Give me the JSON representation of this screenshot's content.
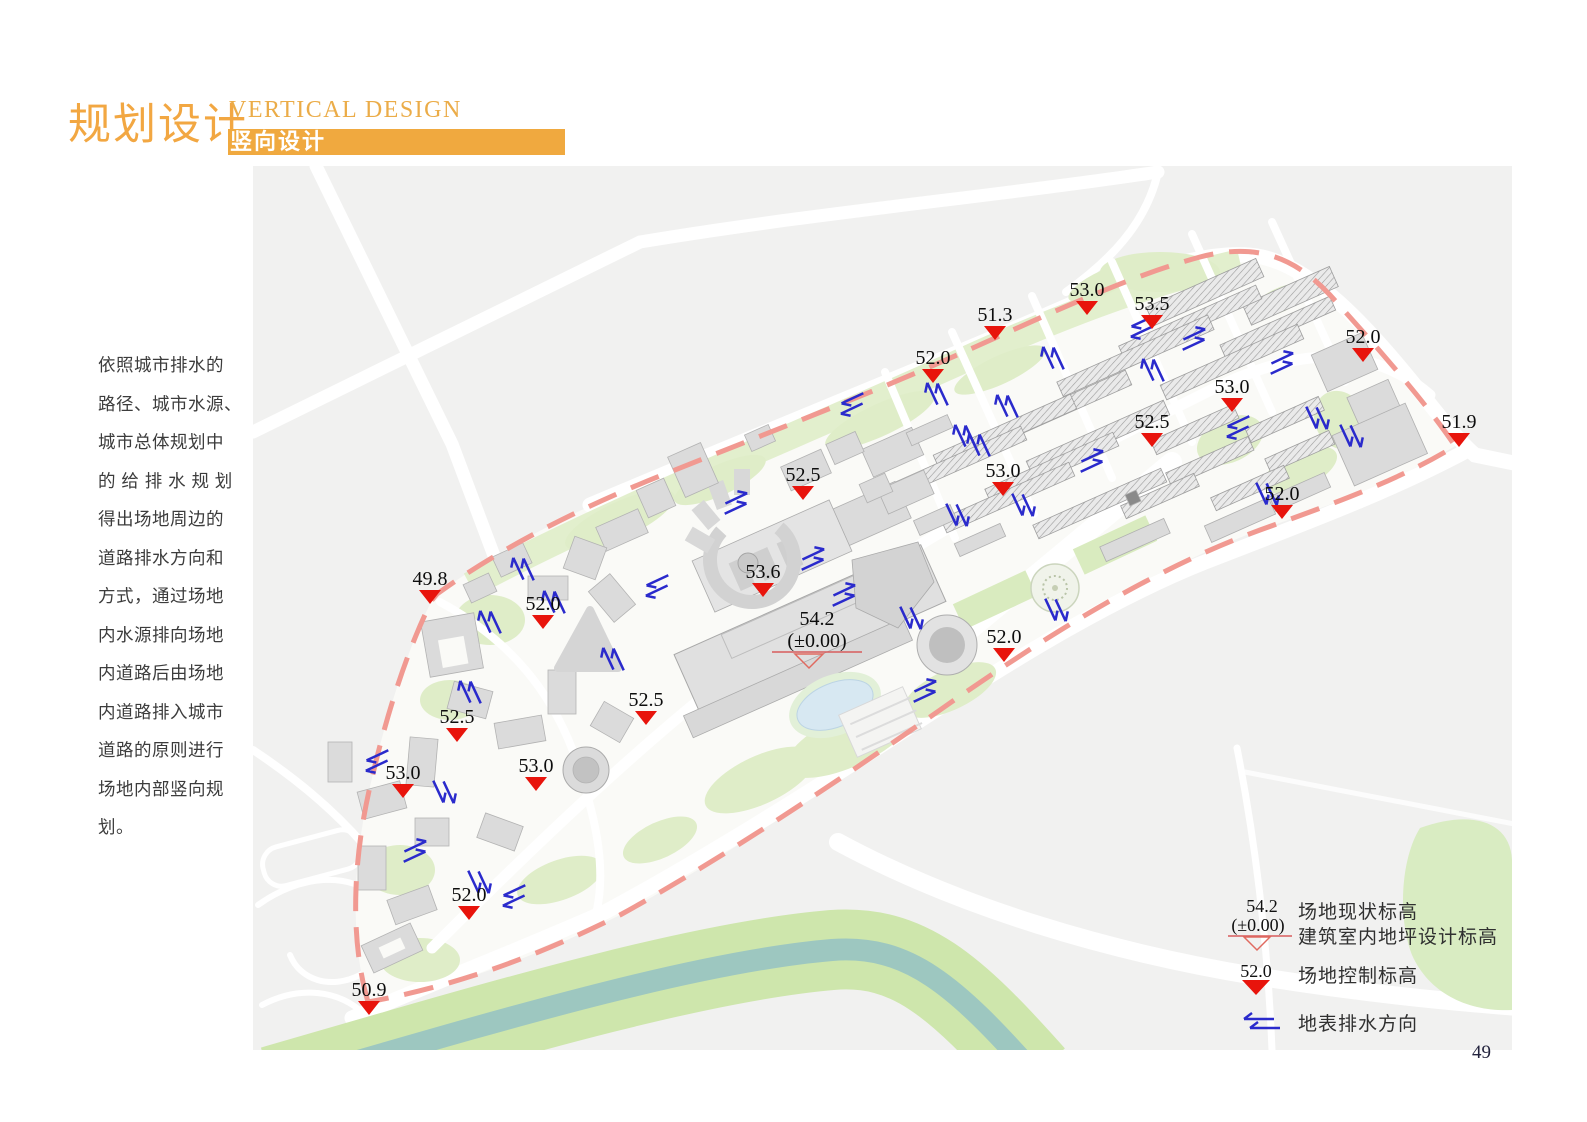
{
  "header": {
    "title_cn": "规划设计",
    "subtitle_en": "VERTICAL DESIGN",
    "subtitle_cn": "竖向设计",
    "accent_color": "#F0A93F"
  },
  "intro_text": "依照城市排水的\n路径、城市水源、\n城市总体规划中\n的 给 排 水 规 划\n得出场地周边的\n道路排水方向和\n方式，通过场地\n内水源排向场地\n内道路后由场地\n内道路排入城市\n道路的原则进行\n场地内部竖向规\n划。",
  "map": {
    "colors": {
      "marker_red": "#E8140C",
      "arrow_blue": "#2A2ACC",
      "boundary_dash": "#F19991",
      "river_teal": "#9DC7C0",
      "green": "#DFEDC8"
    },
    "datum_marker": {
      "value": "54.2",
      "sub": "(±0.00)",
      "x": 817,
      "y": 625
    },
    "markers": [
      {
        "value": "53.0",
        "x": 1087,
        "y": 296
      },
      {
        "value": "53.5",
        "x": 1152,
        "y": 310
      },
      {
        "value": "51.3",
        "x": 995,
        "y": 321
      },
      {
        "value": "52.0",
        "x": 1363,
        "y": 343
      },
      {
        "value": "52.0",
        "x": 933,
        "y": 364
      },
      {
        "value": "53.0",
        "x": 1232,
        "y": 393
      },
      {
        "value": "52.5",
        "x": 1152,
        "y": 428
      },
      {
        "value": "51.9",
        "x": 1459,
        "y": 428
      },
      {
        "value": "53.0",
        "x": 1003,
        "y": 477
      },
      {
        "value": "52.5",
        "x": 803,
        "y": 481
      },
      {
        "value": "52.0",
        "x": 1282,
        "y": 500
      },
      {
        "value": "53.6",
        "x": 763,
        "y": 578
      },
      {
        "value": "49.8",
        "x": 430,
        "y": 585
      },
      {
        "value": "52.0",
        "x": 543,
        "y": 610
      },
      {
        "value": "52.0",
        "x": 1004,
        "y": 643
      },
      {
        "value": "52.5",
        "x": 646,
        "y": 706
      },
      {
        "value": "52.5",
        "x": 457,
        "y": 723
      },
      {
        "value": "53.0",
        "x": 536,
        "y": 772
      },
      {
        "value": "53.0",
        "x": 403,
        "y": 779
      },
      {
        "value": "52.0",
        "x": 469,
        "y": 901
      },
      {
        "value": "50.9",
        "x": 369,
        "y": 996
      }
    ],
    "arrows": [
      [
        1140,
        328,
        155
      ],
      [
        1196,
        338,
        -25
      ],
      [
        1284,
        362,
        -25
      ],
      [
        1318,
        420,
        65
      ],
      [
        1236,
        428,
        155
      ],
      [
        1352,
        438,
        65
      ],
      [
        1268,
        496,
        65
      ],
      [
        1052,
        356,
        -115
      ],
      [
        1006,
        404,
        -115
      ],
      [
        964,
        434,
        -115
      ],
      [
        936,
        392,
        -115
      ],
      [
        850,
        405,
        155
      ],
      [
        978,
        443,
        -115
      ],
      [
        1094,
        460,
        -25
      ],
      [
        1024,
        507,
        65
      ],
      [
        958,
        517,
        65
      ],
      [
        912,
        620,
        65
      ],
      [
        846,
        594,
        -25
      ],
      [
        815,
        558,
        -25
      ],
      [
        927,
        690,
        -25
      ],
      [
        1057,
        612,
        65
      ],
      [
        738,
        502,
        -25
      ],
      [
        655,
        587,
        155
      ],
      [
        612,
        657,
        -115
      ],
      [
        522,
        567,
        -115
      ],
      [
        489,
        620,
        -115
      ],
      [
        469,
        690,
        -115
      ],
      [
        375,
        762,
        155
      ],
      [
        445,
        794,
        65
      ],
      [
        417,
        850,
        -25
      ],
      [
        480,
        884,
        65
      ],
      [
        512,
        897,
        155
      ],
      [
        553,
        600,
        -115
      ],
      [
        1152,
        368,
        -115
      ]
    ]
  },
  "legend": {
    "items": [
      {
        "icon": "datum-marker",
        "value": "54.2",
        "sub": "(±0.00)",
        "label1": "场地现状标高",
        "label2": "建筑室内地坪设计标高"
      },
      {
        "icon": "control-marker",
        "value": "52.0",
        "label": "场地控制标高"
      },
      {
        "icon": "drain-arrow",
        "label": "地表排水方向"
      }
    ]
  },
  "page": {
    "number": "49"
  }
}
